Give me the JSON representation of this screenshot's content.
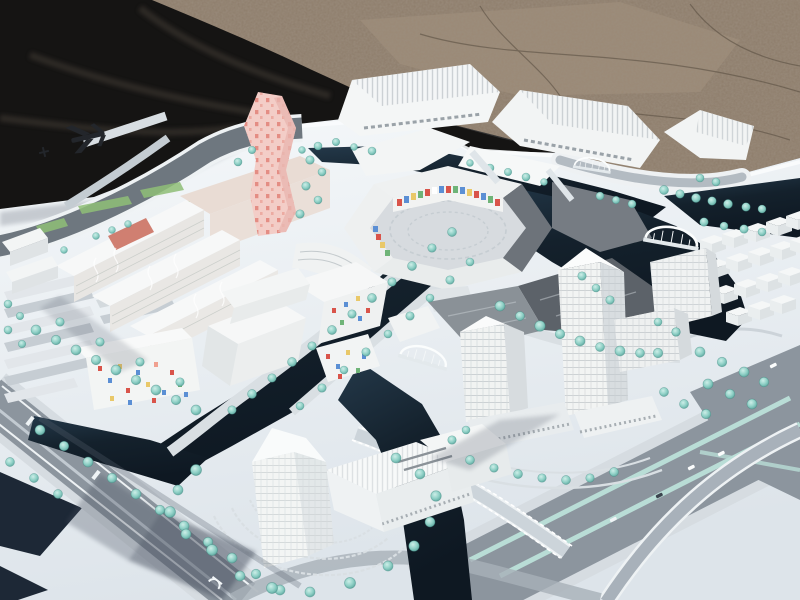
{
  "meta": {
    "type": "photograph",
    "subject": "architectural scale model of a waterfront urban district with canals, towers and tree-lined boulevards",
    "setting": "white model base board displayed outdoors on brown gravel ground, black tarp behind upper-left",
    "view": "elevated oblique view, no legible text visible"
  },
  "palette": {
    "gravel": "#8d7c6a",
    "gravelLight": "#a7947e",
    "crack": "#564b3e",
    "tarp": "#151413",
    "tarpFold": "#3d3730",
    "boardTop": "#f5f8fa",
    "boardBottom": "#dde4ea",
    "boardEdge": "#fafcfd",
    "navy": "#1d2836",
    "water": "#14212c",
    "waterLight": "#24394a",
    "road": "#8c959e",
    "roadDark": "#6e777f",
    "sidewalk": "#d6dce1",
    "quay": "#d9dfe3",
    "medianTeal": "#b9ddd6",
    "treeLight": "#cdeee8",
    "tree": "#8fd0c6",
    "treeDark": "#4e9a92",
    "treeEdge": "#3f8a82",
    "building": "#f1f3f2",
    "buildingSide": "#d7dcdf",
    "buildingFace": "#e9edee",
    "metal": "#6d737a",
    "metalDark": "#5c6269",
    "pink": "#f3cdc7",
    "pinkDot": "#e0837b",
    "beige": "#e9dcd4",
    "lawn": "#8fbf77",
    "accentRed": "#d9544a",
    "accentBlue": "#5b8fd4",
    "accentYellow": "#e9c869",
    "accentGreen": "#6fb478",
    "accentTerracotta": "#c96a59",
    "shadow": "#46505f",
    "glyph": "#23262b",
    "white": "#ffffff"
  },
  "icons": {
    "transit_logo_dark": "dark transit/airplane-like logo painted on model road, upper left",
    "metro_mark_white": "small white metro mark painted on lower-left boulevard",
    "arch_bridge": "white arched pedestrian bridges over canals"
  },
  "regions": {
    "background": "gravel ground and black tarp",
    "model_board": "white base board",
    "central_ring": "oval courtyard complex with colored mosaic facade and pink dotted tower",
    "north_row": "long ribbed-roof slab buildings along rear canal",
    "east_towers": "three white high-rise towers by the basin",
    "south_tower": "translucent landmark tower with podium and circular plaza",
    "west_cluster": "slab housing with wavy facades, parking lots",
    "canals": "dark water channels with teal trees on banks"
  }
}
